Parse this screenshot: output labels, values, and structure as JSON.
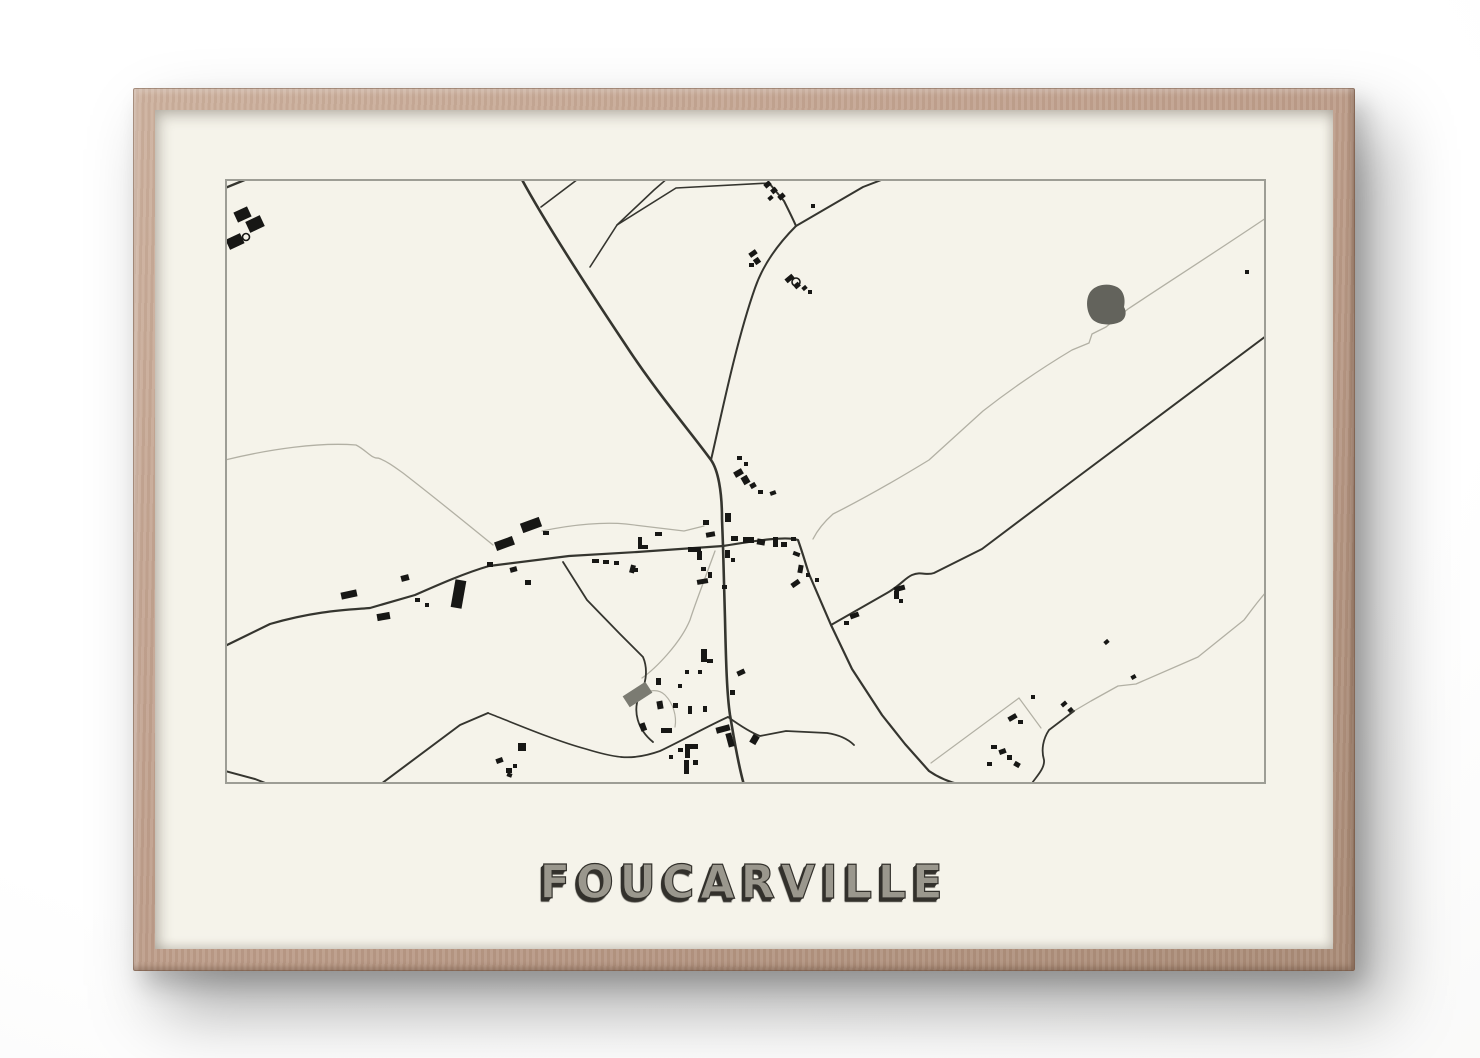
{
  "scene": {
    "wall_color": "#fafaf9"
  },
  "frame": {
    "wood_color": "#bf9f8c",
    "wood_light": "#cdb19e",
    "wood_dark": "#a98b77"
  },
  "poster": {
    "title": "FOUCARVILLE",
    "paper_color": "#f5f3ea",
    "title_fill_color": "#9a978d",
    "title_shadow_color": "#33312c"
  },
  "map": {
    "width": 1041,
    "height": 605,
    "border_color": "#9d9d95",
    "road_dark_color": "#35352f",
    "road_light_color": "#b2b0a4",
    "building_color": "#171715",
    "pond_color": "#63635c",
    "gray_building_color": "#7b7b72",
    "roads": [
      {
        "d": "M 0 9 L 27 -2",
        "tone": "dark",
        "w": 2.4
      },
      {
        "d": "M 295 -3 C 318 40 360 105 400 165 C 432 214 468 256 486 281 C 493 291 497 312 497 340 L 498 367 L 500 440 C 501 485 502 516 505 536 C 508 553 512 581 519 606",
        "tone": "dark",
        "w": 2.6
      },
      {
        "d": "M 486 281 C 496 238 511 163 530 109 C 539 83 556 62 571 47",
        "tone": "dark",
        "w": 2
      },
      {
        "d": "M 544 4 L 559 22 C 564 32 568 40 571 47",
        "tone": "dark",
        "w": 2
      },
      {
        "d": "M 571 47 L 638 8 L 664 -2",
        "tone": "dark",
        "w": 2
      },
      {
        "d": "M 316 28 L 357 -3",
        "tone": "dark",
        "w": 1.6
      },
      {
        "d": "M 365 88 L 392 46 L 429 11 L 444 -2",
        "tone": "dark",
        "w": 1.6
      },
      {
        "d": "M 392 46 L 451 9 L 544 4",
        "tone": "dark",
        "w": 1.6
      },
      {
        "d": "M 0 467 L 45 445 C 90 432 120 431 145 429 L 190 416 C 215 405 240 394 264 387 L 344 377 L 412 373 L 498 367",
        "tone": "dark",
        "w": 2.2
      },
      {
        "d": "M 498 367 C 535 361 562 357 573 361 C 578 375 581 386 584 395 L 606 446 L 627 490 L 657 536 L 680 565 L 704 592 C 714 599 726 604 741 607",
        "tone": "dark",
        "w": 2.2
      },
      {
        "d": "M 606 446 L 662 414 C 676 406 680 399 687 396 C 697 392 701 397 709 394 L 757 370 L 846 303 L 1041 157",
        "tone": "dark",
        "w": 2
      },
      {
        "d": "M 503 538 C 485 546 456 562 435 572 C 421 577 407 579 396 578",
        "tone": "dark",
        "w": 1.8
      },
      {
        "d": "M 503 538 C 517 548 527 554 535 557 L 561 552 L 602 554 C 615 556 623 560 629 566",
        "tone": "dark",
        "w": 1.8
      },
      {
        "d": "M 156 605 L 235 546 L 263 534",
        "tone": "dark",
        "w": 2
      },
      {
        "d": "M 263 534 C 291 545 331 562 361 570 C 374 574 386 577 396 578",
        "tone": "dark",
        "w": 1.6
      },
      {
        "d": "M 0 592 L 30 600 L 48 607",
        "tone": "dark",
        "w": 2
      },
      {
        "d": "M 849 532 L 824 551 C 818 560 816 571 819 581 C 820 590 810 599 805 607",
        "tone": "dark",
        "w": 1.8
      },
      {
        "d": "M 338 383 L 362 421 L 395 455 L 418 478 C 424 492 420 508 414 517 C 408 532 412 550 428 563",
        "tone": "dark",
        "w": 1.8
      },
      {
        "d": "M 1041 39 C 995 70 936 108 903 130 L 881 148 L 867 155 L 864 164 L 847 171 C 812 192 781 214 758 232 L 704 281 C 668 303 636 321 608 335 C 599 343 592 352 588 360",
        "tone": "light",
        "w": 1.3
      },
      {
        "d": "M 0 281 C 45 270 95 263 131 266 C 141 271 147 280 153 279 C 162 282 171 289 178 294 C 209 318 241 344 268 366",
        "tone": "light",
        "w": 1.3
      },
      {
        "d": "M 490 372 C 478 405 470 425 465 441 C 455 465 430 490 417 499",
        "tone": "light",
        "w": 1.3
      },
      {
        "d": "M 1041 413 C 1029 427 1023 436 1019 441 L 973 478 L 911 505 L 893 507 L 866 522 L 849 532",
        "tone": "light",
        "w": 1.3
      },
      {
        "d": "M 794 519 L 706 584",
        "tone": "light",
        "w": 1.2
      },
      {
        "d": "M 794 519 L 816 549",
        "tone": "light",
        "w": 1.2
      },
      {
        "d": "M 317 352 C 350 345 380 343 401 345 L 459 352 L 479 347",
        "tone": "light",
        "w": 1.2
      },
      {
        "d": "M 414 517 C 424 510 434 510 440 516 C 448 524 452 537 450 548",
        "tone": "light",
        "w": 1.2
      }
    ],
    "areas": [
      {
        "name": "pond",
        "d": "M 866 112 C 872 105 884 104 892 108 C 898 111 901 119 899 128 C 902 133 901 140 895 143 C 886 147 874 146 868 141 C 861 134 860 119 866 112 Z"
      },
      {
        "name": "gray-building",
        "x": 399,
        "y": 509,
        "w": 27,
        "h": 13,
        "r": -33
      }
    ],
    "buildings": [
      {
        "x": 10,
        "y": 30,
        "w": 15,
        "h": 11,
        "r": -25
      },
      {
        "x": 22,
        "y": 39,
        "w": 16,
        "h": 12,
        "r": -25
      },
      {
        "x": 2,
        "y": 57,
        "w": 16,
        "h": 11,
        "r": -25
      },
      {
        "x": 539,
        "y": 3,
        "w": 7,
        "h": 5,
        "r": -40
      },
      {
        "x": 546,
        "y": 9,
        "w": 6,
        "h": 5,
        "r": -40
      },
      {
        "x": 553,
        "y": 15,
        "w": 7,
        "h": 5,
        "r": -40
      },
      {
        "x": 543,
        "y": 17,
        "w": 5,
        "h": 4,
        "r": -40
      },
      {
        "x": 586,
        "y": 25,
        "w": 4,
        "h": 4,
        "r": 0
      },
      {
        "x": 524,
        "y": 72,
        "w": 8,
        "h": 5,
        "r": -35
      },
      {
        "x": 529,
        "y": 79,
        "w": 6,
        "h": 6,
        "r": -35
      },
      {
        "x": 524,
        "y": 84,
        "w": 5,
        "h": 4,
        "r": 0
      },
      {
        "x": 560,
        "y": 97,
        "w": 9,
        "h": 5,
        "r": -40
      },
      {
        "x": 569,
        "y": 104,
        "w": 6,
        "h": 5,
        "r": -40
      },
      {
        "x": 577,
        "y": 107,
        "w": 5,
        "h": 4,
        "r": -40
      },
      {
        "x": 583,
        "y": 111,
        "w": 4,
        "h": 4,
        "r": 0
      },
      {
        "x": 1020,
        "y": 91,
        "w": 4,
        "h": 4,
        "r": 0
      },
      {
        "x": 116,
        "y": 412,
        "w": 16,
        "h": 7,
        "r": -12
      },
      {
        "x": 152,
        "y": 434,
        "w": 13,
        "h": 7,
        "r": -10
      },
      {
        "x": 176,
        "y": 396,
        "w": 8,
        "h": 6,
        "r": -15
      },
      {
        "x": 190,
        "y": 419,
        "w": 5,
        "h": 4,
        "r": 0
      },
      {
        "x": 200,
        "y": 424,
        "w": 4,
        "h": 4,
        "r": 0
      },
      {
        "x": 228,
        "y": 401,
        "w": 11,
        "h": 28,
        "r": 10
      },
      {
        "x": 270,
        "y": 360,
        "w": 19,
        "h": 9,
        "r": -20
      },
      {
        "x": 296,
        "y": 341,
        "w": 20,
        "h": 10,
        "r": -20
      },
      {
        "x": 262,
        "y": 383,
        "w": 6,
        "h": 5,
        "r": 0
      },
      {
        "x": 285,
        "y": 388,
        "w": 7,
        "h": 5,
        "r": -15
      },
      {
        "x": 300,
        "y": 401,
        "w": 6,
        "h": 5,
        "r": 0
      },
      {
        "x": 318,
        "y": 352,
        "w": 6,
        "h": 4,
        "r": 0
      },
      {
        "x": 367,
        "y": 380,
        "w": 7,
        "h": 4,
        "r": 0
      },
      {
        "x": 378,
        "y": 381,
        "w": 6,
        "h": 4,
        "r": 0
      },
      {
        "x": 389,
        "y": 382,
        "w": 5,
        "h": 4,
        "r": 0
      },
      {
        "x": 408,
        "y": 389,
        "w": 5,
        "h": 4,
        "r": 0
      },
      {
        "x": 509,
        "y": 291,
        "w": 9,
        "h": 6,
        "r": -30
      },
      {
        "x": 517,
        "y": 297,
        "w": 7,
        "h": 8,
        "r": -30
      },
      {
        "x": 525,
        "y": 304,
        "w": 6,
        "h": 5,
        "r": -30
      },
      {
        "x": 533,
        "y": 311,
        "w": 5,
        "h": 4,
        "r": 0
      },
      {
        "x": 545,
        "y": 312,
        "w": 6,
        "h": 4,
        "r": -20
      },
      {
        "x": 512,
        "y": 277,
        "w": 5,
        "h": 4,
        "r": 0
      },
      {
        "x": 519,
        "y": 283,
        "w": 4,
        "h": 4,
        "r": 0
      },
      {
        "x": 500,
        "y": 334,
        "w": 6,
        "h": 9,
        "r": 0
      },
      {
        "x": 478,
        "y": 341,
        "w": 6,
        "h": 5,
        "r": 0
      },
      {
        "x": 481,
        "y": 353,
        "w": 9,
        "h": 5,
        "r": -10
      },
      {
        "x": 506,
        "y": 357,
        "w": 7,
        "h": 5,
        "r": 0
      },
      {
        "x": 518,
        "y": 358,
        "w": 11,
        "h": 6,
        "r": 0
      },
      {
        "x": 532,
        "y": 360,
        "w": 8,
        "h": 6,
        "r": 10
      },
      {
        "x": 430,
        "y": 353,
        "w": 7,
        "h": 4,
        "r": 0
      },
      {
        "x": 413,
        "y": 358,
        "w": 4,
        "h": 10,
        "r": 0
      },
      {
        "x": 413,
        "y": 366,
        "w": 10,
        "h": 4,
        "r": 0
      },
      {
        "x": 405,
        "y": 386,
        "w": 5,
        "h": 8,
        "r": 15
      },
      {
        "x": 463,
        "y": 368,
        "w": 13,
        "h": 5,
        "r": 0
      },
      {
        "x": 472,
        "y": 372,
        "w": 5,
        "h": 9,
        "r": 0
      },
      {
        "x": 500,
        "y": 371,
        "w": 5,
        "h": 8,
        "r": 0
      },
      {
        "x": 506,
        "y": 379,
        "w": 4,
        "h": 4,
        "r": 0
      },
      {
        "x": 476,
        "y": 388,
        "w": 5,
        "h": 4,
        "r": 0
      },
      {
        "x": 483,
        "y": 393,
        "w": 4,
        "h": 6,
        "r": 0
      },
      {
        "x": 472,
        "y": 400,
        "w": 11,
        "h": 5,
        "r": -10
      },
      {
        "x": 497,
        "y": 406,
        "w": 5,
        "h": 4,
        "r": 0
      },
      {
        "x": 548,
        "y": 358,
        "w": 5,
        "h": 10,
        "r": 0
      },
      {
        "x": 556,
        "y": 363,
        "w": 6,
        "h": 5,
        "r": 0
      },
      {
        "x": 566,
        "y": 358,
        "w": 5,
        "h": 4,
        "r": 0
      },
      {
        "x": 568,
        "y": 373,
        "w": 7,
        "h": 4,
        "r": 20
      },
      {
        "x": 573,
        "y": 386,
        "w": 5,
        "h": 8,
        "r": 10
      },
      {
        "x": 581,
        "y": 394,
        "w": 4,
        "h": 4,
        "r": 0
      },
      {
        "x": 566,
        "y": 402,
        "w": 9,
        "h": 5,
        "r": -35
      },
      {
        "x": 590,
        "y": 399,
        "w": 4,
        "h": 4,
        "r": 0
      },
      {
        "x": 476,
        "y": 470,
        "w": 6,
        "h": 13,
        "r": 0
      },
      {
        "x": 482,
        "y": 480,
        "w": 6,
        "h": 4,
        "r": 0
      },
      {
        "x": 460,
        "y": 491,
        "w": 4,
        "h": 4,
        "r": 0
      },
      {
        "x": 473,
        "y": 491,
        "w": 4,
        "h": 4,
        "r": 0
      },
      {
        "x": 512,
        "y": 491,
        "w": 8,
        "h": 5,
        "r": -25
      },
      {
        "x": 431,
        "y": 499,
        "w": 5,
        "h": 7,
        "r": 0
      },
      {
        "x": 448,
        "y": 524,
        "w": 5,
        "h": 5,
        "r": 0
      },
      {
        "x": 432,
        "y": 522,
        "w": 6,
        "h": 8,
        "r": -10
      },
      {
        "x": 463,
        "y": 527,
        "w": 4,
        "h": 8,
        "r": 0
      },
      {
        "x": 478,
        "y": 527,
        "w": 4,
        "h": 6,
        "r": 0
      },
      {
        "x": 505,
        "y": 511,
        "w": 5,
        "h": 5,
        "r": 0
      },
      {
        "x": 453,
        "y": 505,
        "w": 4,
        "h": 4,
        "r": 0
      },
      {
        "x": 415,
        "y": 544,
        "w": 6,
        "h": 8,
        "r": -20
      },
      {
        "x": 436,
        "y": 549,
        "w": 11,
        "h": 5,
        "r": 0
      },
      {
        "x": 453,
        "y": 569,
        "w": 5,
        "h": 4,
        "r": 0
      },
      {
        "x": 460,
        "y": 565,
        "w": 13,
        "h": 5,
        "r": 0
      },
      {
        "x": 460,
        "y": 570,
        "w": 5,
        "h": 9,
        "r": 0
      },
      {
        "x": 444,
        "y": 576,
        "w": 4,
        "h": 4,
        "r": 0
      },
      {
        "x": 459,
        "y": 581,
        "w": 5,
        "h": 14,
        "r": 0
      },
      {
        "x": 468,
        "y": 581,
        "w": 5,
        "h": 5,
        "r": 0
      },
      {
        "x": 491,
        "y": 547,
        "w": 14,
        "h": 6,
        "r": -15
      },
      {
        "x": 502,
        "y": 554,
        "w": 6,
        "h": 14,
        "r": -15
      },
      {
        "x": 526,
        "y": 556,
        "w": 7,
        "h": 9,
        "r": 30
      },
      {
        "x": 271,
        "y": 579,
        "w": 7,
        "h": 5,
        "r": -20
      },
      {
        "x": 281,
        "y": 589,
        "w": 6,
        "h": 5,
        "r": 0
      },
      {
        "x": 288,
        "y": 585,
        "w": 4,
        "h": 4,
        "r": 0
      },
      {
        "x": 293,
        "y": 564,
        "w": 8,
        "h": 8,
        "r": 0
      },
      {
        "x": 282,
        "y": 594,
        "w": 5,
        "h": 4,
        "r": 20
      },
      {
        "x": 669,
        "y": 407,
        "w": 11,
        "h": 5,
        "r": -15
      },
      {
        "x": 669,
        "y": 412,
        "w": 5,
        "h": 8,
        "r": 0
      },
      {
        "x": 674,
        "y": 420,
        "w": 4,
        "h": 4,
        "r": 0
      },
      {
        "x": 625,
        "y": 434,
        "w": 9,
        "h": 5,
        "r": -20
      },
      {
        "x": 619,
        "y": 442,
        "w": 5,
        "h": 4,
        "r": 0
      },
      {
        "x": 783,
        "y": 536,
        "w": 9,
        "h": 5,
        "r": -30
      },
      {
        "x": 793,
        "y": 541,
        "w": 5,
        "h": 4,
        "r": 0
      },
      {
        "x": 836,
        "y": 523,
        "w": 6,
        "h": 4,
        "r": -40
      },
      {
        "x": 843,
        "y": 529,
        "w": 5,
        "h": 4,
        "r": -40
      },
      {
        "x": 766,
        "y": 566,
        "w": 6,
        "h": 4,
        "r": 0
      },
      {
        "x": 774,
        "y": 570,
        "w": 7,
        "h": 5,
        "r": -20
      },
      {
        "x": 782,
        "y": 576,
        "w": 5,
        "h": 5,
        "r": 0
      },
      {
        "x": 762,
        "y": 583,
        "w": 5,
        "h": 4,
        "r": 0
      },
      {
        "x": 789,
        "y": 583,
        "w": 6,
        "h": 5,
        "r": 30
      },
      {
        "x": 806,
        "y": 516,
        "w": 4,
        "h": 4,
        "r": 0
      },
      {
        "x": 906,
        "y": 496,
        "w": 5,
        "h": 4,
        "r": -30
      },
      {
        "x": 879,
        "y": 461,
        "w": 5,
        "h": 4,
        "r": -40
      }
    ],
    "circles": [
      {
        "cx": 21,
        "cy": 58,
        "r": 3.5
      },
      {
        "cx": 571,
        "cy": 103,
        "r": 4
      }
    ]
  }
}
